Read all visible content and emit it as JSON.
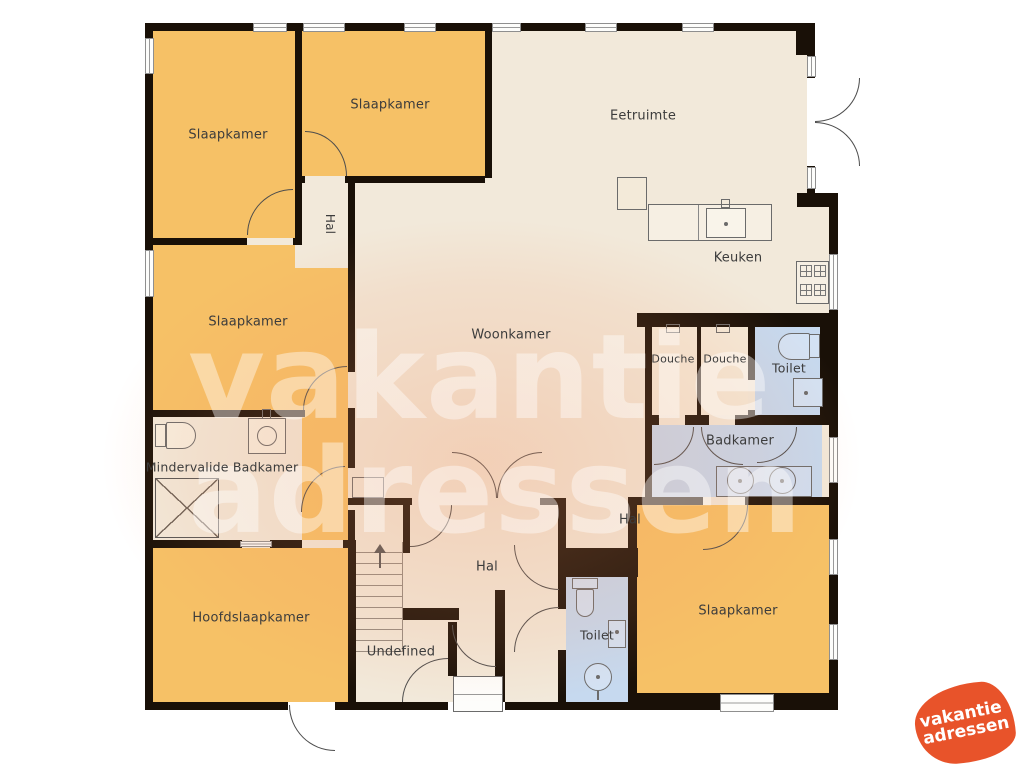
{
  "title": "Plattegrond vakantiehuis",
  "colors": {
    "wall": "#191007",
    "room_orange": "#f6c166",
    "room_cream": "#f2e9da",
    "room_blue": "#c6d9ef",
    "label_text": "#3c3c3c",
    "logo_orange": "#e8532a",
    "watermark_glow": "rgba(244,148,100,0.30)"
  },
  "rooms": {
    "slaapkamer_tl": "Slaapkamer",
    "slaapkamer_tm": "Slaapkamer",
    "slaapkamer_ml": "Slaapkamer",
    "slaapkamer_br": "Slaapkamer",
    "hoofdslaapkamer": "Hoofdslaapkamer",
    "eetruimte": "Eetruimte",
    "keuken": "Keuken",
    "woonkamer": "Woonkamer",
    "hal_top": "Hal",
    "hal_mid": "Hal",
    "hal_bottom": "Hal",
    "douche1": "Douche",
    "douche2": "Douche",
    "toilet_top": "Toilet",
    "toilet_bottom": "Toilet",
    "badkamer": "Badkamer",
    "mindervalide_badkamer": "Mindervalide Badkamer",
    "undefined_room": "Undefined"
  },
  "watermark": {
    "line1": "vakantie",
    "line2": "adressen"
  },
  "logo": {
    "line1": "vakantie",
    "line2": "adressen"
  }
}
